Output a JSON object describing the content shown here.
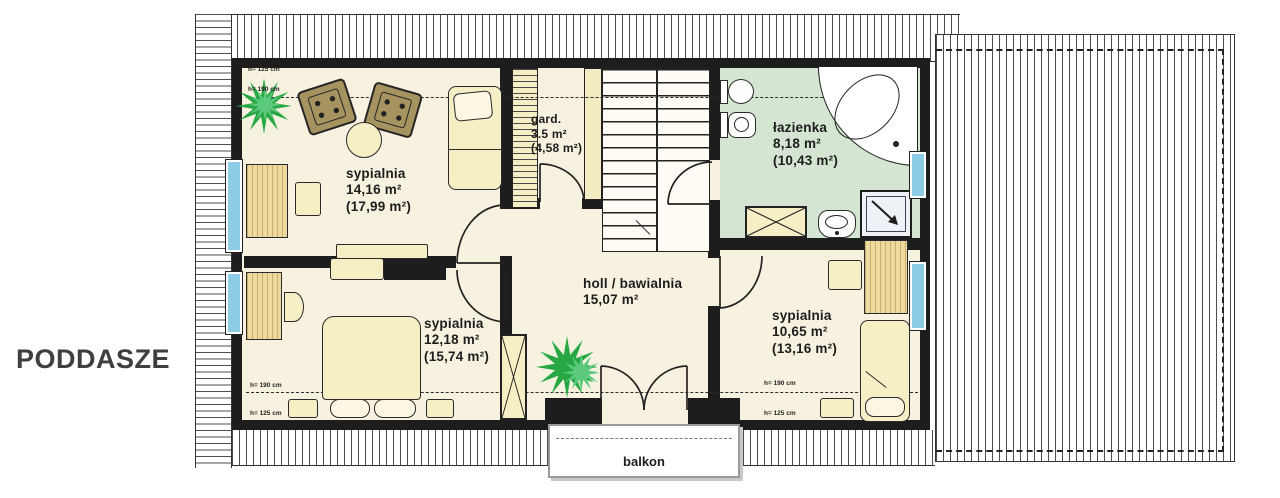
{
  "title": "PODDASZE",
  "rooms": [
    {
      "name": "sypialnia",
      "area": "14,16 m²",
      "gross": "(17,99 m²)"
    },
    {
      "name": "gard.",
      "area": "3.5 m²",
      "gross": "(4,58 m²)"
    },
    {
      "name": "łazienka",
      "area": "8,18 m²",
      "gross": "(10,43 m²)"
    },
    {
      "name": "holl / bawialnia",
      "area": "15,07 m²",
      "gross": ""
    },
    {
      "name": "sypialnia",
      "area": "12,18 m²",
      "gross": "(15,74 m²)"
    },
    {
      "name": "sypialnia",
      "area": "10,65 m²",
      "gross": "(13,16 m²)"
    }
  ],
  "balcony_label": "balkon",
  "height_marks": {
    "h125": "h= 125 cm",
    "h190": "h= 190 cm"
  },
  "colors": {
    "wall": "#1d1d1d",
    "floor_cream": "#f7f2df",
    "furniture_cream": "#f6efc5",
    "wood": "#eeda9f",
    "bathroom_green": "#d4e6d1",
    "plant_green": "#2aa84a",
    "window_blue": "#8ecbe4",
    "armchair_brown": "#a6935f"
  }
}
